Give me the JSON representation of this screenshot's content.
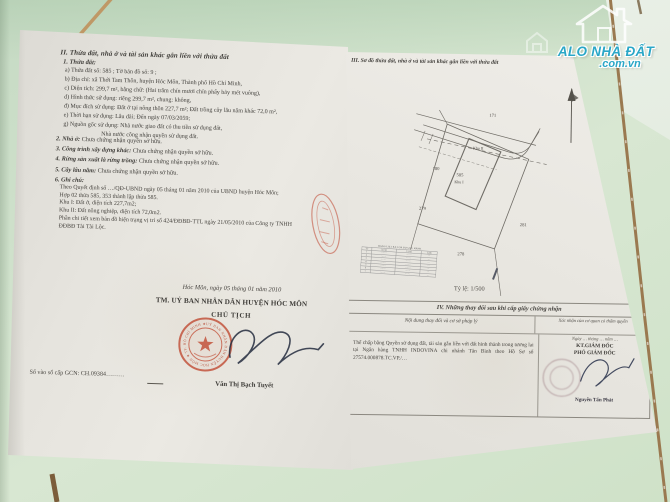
{
  "watermark": {
    "brand": "ALO NHÀ ĐẤT",
    "domain": ".com.vn"
  },
  "left_page": {
    "section2_heading": "II. Thửa đất, nhà ở và tài sản khác gắn liền với thửa đất",
    "parcel_label": "1. Thửa đất:",
    "parcel_lines": [
      "a) Thửa đất số: 585 ;  Tờ bản đồ số: 9 ;",
      "b) Địa chỉ: xã Thới Tam Thôn, huyện Hóc Môn, Thành phố Hồ Chí Minh,",
      "c) Diện tích: 299,7 m², bằng chữ: (Hai trăm chín mươi chín phẩy bảy mét vuông),",
      "d) Hình thức sử dụng: riêng 299,7 m², chung: không,",
      "đ) Mục đích sử dụng: Đất ở tại nông thôn 227,7 m²; Đất trồng cây lâu năm khác 72,0 m²,",
      "e) Thời hạn sử dụng: Lâu dài; Đến ngày 07/03/2059;",
      "g) Nguồn gốc sử dụng: Nhà nước giao đất có thu tiền sử dụng đất,",
      "Nhà nước công nhận quyền sử dụng đất."
    ],
    "items": [
      {
        "label": "2. Nhà ở:",
        "text": " Chưa chứng nhận quyền sở hữu."
      },
      {
        "label": "3. Công trình xây dựng khác:",
        "text": " Chưa chứng nhận quyền sở hữu."
      },
      {
        "label": "4. Rừng sản xuất là rừng trồng:",
        "text": " Chưa chứng nhận quyền sở hữu."
      },
      {
        "label": "5. Cây lâu năm:",
        "text": " Chưa chứng nhận quyền sở hữu."
      },
      {
        "label": "6. Ghi chú:",
        "text": ""
      }
    ],
    "notes": [
      "Theo Quyết định số …/QĐ-UBND ngày 05 tháng 01 năm 2010 của UBND huyện Hóc Môn;",
      "Hợp 02 thửa 585, 353 thành lập thửa 585.",
      "Khu I: Đất ở, diện tích 227,7m2;",
      "Khu II: Đất nông nghiệp, diện tích 72,0m2.",
      "Phần chi tiết xem bản đồ hiện trạng vị trí số 424/ĐĐBĐ-TTL ngày 21/05/2010 của Công ty TNHH",
      "ĐĐBĐ Tài Tài Lộc."
    ],
    "issue": {
      "place_date": "Hóc Môn, ngày 05  tháng 01  năm 2010",
      "committee": "TM. UỶ BAN NHÂN DÂN HUYỆN HÓC MÔN",
      "chairman_title": "CHỦ TỊCH",
      "signer": "Văn Thị Bạch Tuyết",
      "seal_text": "UỶ BAN NHÂN DÂN HUYỆN HÓC MÔN ★ TP. HỒ CHÍ MINH ★"
    },
    "book_number": "Số vào sổ cấp GCN: CH.09384………"
  },
  "right_page": {
    "section3_heading": "III. Sơ đồ thửa đất, nhà ở và tài sản khác gắn liền với thửa đất",
    "map": {
      "labels": {
        "parcel": "585",
        "khu1": "Khu I",
        "khu2": "Khu II",
        "n171": "171",
        "n180": "180",
        "n279": "279",
        "n278": "278",
        "n281": "281"
      },
      "scale": "Tỷ lệ: 1/500",
      "coord_table": {
        "title": "BẢNG LIỆT KÊ TỌA ĐỘ GÓC RANH",
        "headers": [
          "TT",
          "X (m)",
          "Y (m)",
          "Cạnh"
        ],
        "rows": [
          [
            "1",
            "·······",
            "·······",
            "···"
          ],
          [
            "2",
            "·······",
            "·······",
            "···"
          ],
          [
            "3",
            "·······",
            "·······",
            "···"
          ],
          [
            "4",
            "·······",
            "·······",
            "···"
          ],
          [
            "5",
            "·······",
            "·······",
            "···"
          ],
          [
            "6",
            "·······",
            "·······",
            "···"
          ],
          [
            "7",
            "·······",
            "·······",
            "···"
          ]
        ]
      }
    },
    "section4": {
      "heading": "IV. Những thay đổi sau khi cấp giấy chứng nhận",
      "col1": "Nội dung thay đổi và cơ sở pháp lý",
      "col2": "Xác nhận của cơ quan có thẩm quyền",
      "entry": "Thế chấp bằng Quyền sử dụng đất, tài sản gắn liền với đất hình thành trong tương lai tại Ngân hàng TNHH INDOVINA chi nhánh Tân Bình theo Hồ Sơ số 27574.000878.TC.VP./…",
      "confirm_date": "Ngày … tháng … năm …",
      "confirm_title1": "KT.GIÁM ĐỐC",
      "confirm_title2": "PHÓ GIÁM ĐỐC",
      "confirm_signer": "Nguyễn Tấn Phát"
    }
  }
}
